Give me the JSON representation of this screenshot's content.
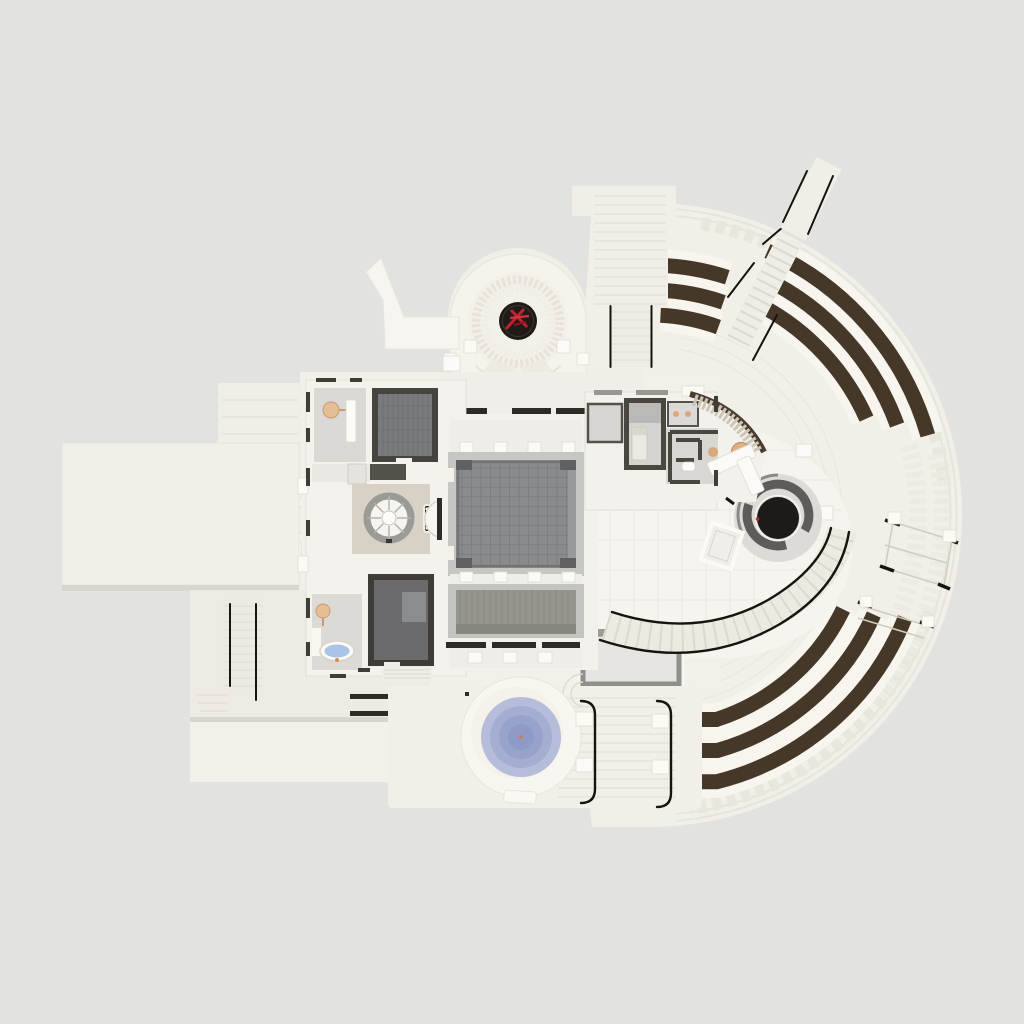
{
  "meta": {
    "kind": "3d-rendered architectural floor plan, top-down view",
    "visible_text": "none"
  },
  "palette": {
    "bg": "#e2e2e1",
    "plaza": "#f1efe8",
    "platform": "#f0eee7",
    "backdrop": "#f2f0e9",
    "interior": "#f5f4ef",
    "cream-bright": "#f6f4ee",
    "step-line": "#e3e0d6",
    "bench": "#463829",
    "bench-pad": "#f7f5ee",
    "wall-dark": "#403c36",
    "lintel": "#2e2a26",
    "hall-floor": "#8a8b8d",
    "hall-frame": "#c6c6c2",
    "plank-floor": "#96958d",
    "media-floor": "#6b6b6d",
    "gym-floor": "#797b7e",
    "room-floor": "#dad9d5",
    "terrazzo": "#d8d2c6",
    "spiral-ring": "#9a9a97",
    "pool-1": "#b6bdda",
    "pool-2": "#a4aed3",
    "pool-3": "#98a3cb",
    "pool-4": "#8f9bc6",
    "tub-water": "#a9c4e6",
    "wood": "#ddb086",
    "rail": "#17130f",
    "emblem-red": "#c31f2d",
    "emblem-disc": "#1f1b18",
    "rotunda-dark": "#1d1a17",
    "rotunda-ring": "#5d5c5a",
    "white": "#fbfaf6",
    "shadow": "#d9d6cd",
    "gray-border": "#8f8f8c"
  },
  "scene": {
    "features": [
      {
        "id": "apse-pavilion",
        "label": "semicircular apse pavilion with sunburst paving and fan steps"
      },
      {
        "id": "red-sculpture-medallion",
        "label": "black circular medallion with red abstract sculpture"
      },
      {
        "id": "sculptural-wall",
        "label": "freeform white wall north-west of the apse"
      },
      {
        "id": "north-walkway",
        "label": "stepped entry walkway from the north with twin handrails"
      },
      {
        "id": "amphitheater-terrace",
        "label": "semicircular stepped terrace with nine curved dark-brown benches in three groups"
      },
      {
        "id": "radial-stair",
        "label": "radial stair with black handrails cutting through the benches toward the north-east"
      },
      {
        "id": "pergolas",
        "label": "two thin-frame pergolas on the east terrace"
      },
      {
        "id": "fire-pit-rotunda",
        "label": "dark circular fire pit / oculus with broken gray ring on the east plaza"
      },
      {
        "id": "curved-ramp",
        "label": "curved stepped ramp with black handrails sweeping around the plaza"
      },
      {
        "id": "great-hall-upper",
        "label": "large hall with dark square-tiled floor"
      },
      {
        "id": "great-hall-lower",
        "label": "second hall with plank-striped gray floor"
      },
      {
        "id": "gym-room",
        "label": "dark-walled room with striped gray floor (north-west)"
      },
      {
        "id": "media-room",
        "label": "dark-walled room with charcoal floor (south-west)"
      },
      {
        "id": "lounge",
        "label": "room with round wooden table and white credenza"
      },
      {
        "id": "bathroom",
        "label": "bathroom with oval blue-water bathtub and round wooden stool"
      },
      {
        "id": "spiral-staircase",
        "label": "spiral staircase on a terrazzo landing"
      },
      {
        "id": "elevator",
        "label": "black elevator cab beside the spiral stair"
      },
      {
        "id": "bedroom",
        "label": "small bedroom with bed in the east room cluster"
      },
      {
        "id": "restroom",
        "label": "restroom with stall partitions and toilet in the east cluster"
      },
      {
        "id": "dining-table",
        "label": "round wooden dining table with stool on a speckled patio"
      },
      {
        "id": "reception-desk",
        "label": "white L-shaped desk near the plaza"
      },
      {
        "id": "skylight-basin",
        "label": "rectangular gray-framed sunken basin south of the halls"
      },
      {
        "id": "spa-pool",
        "label": "round plunge pool with concentric blue-violet rings"
      },
      {
        "id": "south-stairs",
        "label": "two straight stairs descending south with J-hooked handrails"
      },
      {
        "id": "west-terrace",
        "label": "large plain cream terrace west of the house"
      },
      {
        "id": "lower-terrace",
        "label": "second cream terrace at the south-west"
      },
      {
        "id": "west-sidewalk",
        "label": "paved walk along the west facade with semicircular steps"
      },
      {
        "id": "sw-stairs",
        "label": "south-west staircases with handrails"
      }
    ],
    "counts": {
      "bench_arcs": 9,
      "bench_groups": 3,
      "pool_rings": 4,
      "pergolas": 2,
      "south_stair_rails": 2
    }
  }
}
